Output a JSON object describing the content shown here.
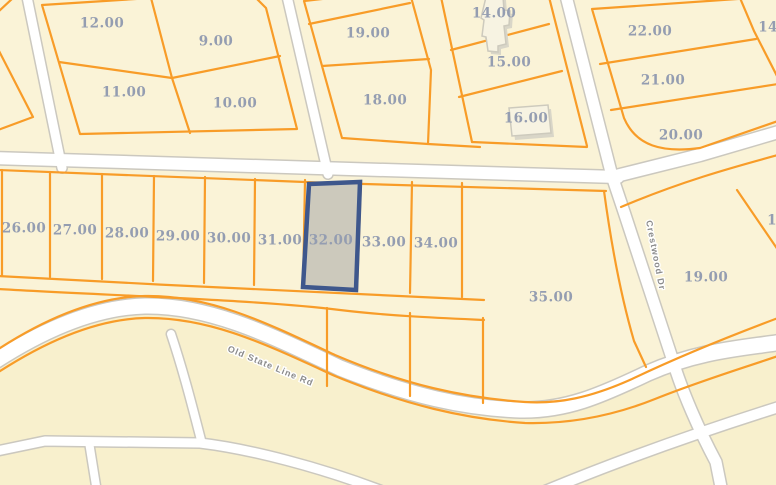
{
  "map": {
    "colors": {
      "background": "#FAF3D7",
      "background_south": "#F8F0CD",
      "parcel_line": "#F89C28",
      "road_fill": "#FFFFFF",
      "road_casing": "#CBC8BF",
      "parcel_label": "#949DB1",
      "road_label": "#8B8B8B",
      "selected_fill": "#CAC7BA",
      "selected_border": "#3E578C"
    },
    "selected_parcel": {
      "label": "32.00"
    },
    "road_labels": [
      {
        "name": "Old State Line Rd"
      },
      {
        "name": "Crestwood Dr"
      }
    ],
    "parcel_labels": [
      {
        "text": "12.00"
      },
      {
        "text": "9.00"
      },
      {
        "text": "11.00"
      },
      {
        "text": "10.00"
      },
      {
        "text": "19.00"
      },
      {
        "text": "18.00"
      },
      {
        "text": "14.00"
      },
      {
        "text": "15.00"
      },
      {
        "text": "16.00"
      },
      {
        "text": "22.00"
      },
      {
        "text": "21.00"
      },
      {
        "text": "20.00"
      },
      {
        "text": "14"
      },
      {
        "text": "26.00"
      },
      {
        "text": "27.00"
      },
      {
        "text": "28.00"
      },
      {
        "text": "29.00"
      },
      {
        "text": "30.00"
      },
      {
        "text": "31.00"
      },
      {
        "text": "33.00"
      },
      {
        "text": "34.00"
      },
      {
        "text": "35.00"
      },
      {
        "text": "19.00"
      },
      {
        "text": "1"
      }
    ]
  }
}
